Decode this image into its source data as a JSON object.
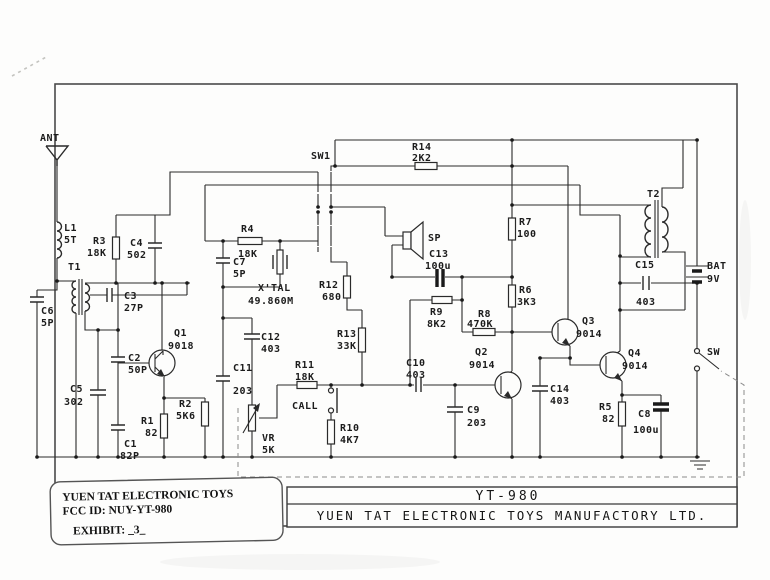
{
  "document": {
    "fcc_label": {
      "company_line": "YUEN TAT ELECTRONIC TOYS",
      "fcc_id_line": "FCC ID: NUY-YT-980",
      "exhibit_line": "EXHIBIT: _3_"
    },
    "title_block": {
      "model": "YT-980",
      "company": "YUEN TAT ELECTRONIC TOYS MANUFACTORY LTD."
    }
  },
  "colors": {
    "ink": "#2a2a2a",
    "paper": "#fdfdfc"
  },
  "schematic": {
    "components": {
      "ant": {
        "ref": "ANT"
      },
      "l1": {
        "ref": "L1",
        "value": "5T"
      },
      "t1": {
        "ref": "T1"
      },
      "t2": {
        "ref": "T2"
      },
      "r1": {
        "ref": "R1",
        "value": "82"
      },
      "r2": {
        "ref": "R2",
        "value": "5K6"
      },
      "r3": {
        "ref": "R3",
        "value": "18K"
      },
      "r4": {
        "ref": "R4",
        "value": "18K"
      },
      "r5": {
        "ref": "R5",
        "value": "82"
      },
      "r6": {
        "ref": "R6",
        "value": "3K3"
      },
      "r7": {
        "ref": "R7",
        "value": "100"
      },
      "r8": {
        "ref": "R8",
        "value": "470K"
      },
      "r9": {
        "ref": "R9",
        "value": "8K2"
      },
      "r10": {
        "ref": "R10",
        "value": "4K7"
      },
      "r11": {
        "ref": "R11",
        "value": "18K"
      },
      "r12": {
        "ref": "R12",
        "value": "680"
      },
      "r13": {
        "ref": "R13",
        "value": "33K"
      },
      "r14": {
        "ref": "R14",
        "value": "2K2"
      },
      "c1": {
        "ref": "C1",
        "value": "82P"
      },
      "c2": {
        "ref": "C2",
        "value": "50P"
      },
      "c3": {
        "ref": "C3",
        "value": "27P"
      },
      "c4": {
        "ref": "C4",
        "value": "502"
      },
      "c5": {
        "ref": "C5",
        "value": "302"
      },
      "c6": {
        "ref": "C6",
        "value": "5P"
      },
      "c7": {
        "ref": "C7",
        "value": "5P"
      },
      "c8": {
        "ref": "C8",
        "value": "100u"
      },
      "c9": {
        "ref": "C9",
        "value": "203"
      },
      "c10": {
        "ref": "C10",
        "value": "403"
      },
      "c11": {
        "ref": "C11",
        "value": "203"
      },
      "c12": {
        "ref": "C12",
        "value": "403"
      },
      "c13": {
        "ref": "C13",
        "value": "100u"
      },
      "c14": {
        "ref": "C14",
        "value": "403"
      },
      "c15": {
        "ref": "C15",
        "value": "403"
      },
      "q1": {
        "ref": "Q1",
        "value": "9018"
      },
      "q2": {
        "ref": "Q2",
        "value": "9014"
      },
      "q3": {
        "ref": "Q3",
        "value": "9014"
      },
      "q4": {
        "ref": "Q4",
        "value": "9014"
      },
      "xtal": {
        "ref": "X'TAL",
        "value": "49.860M"
      },
      "vr": {
        "ref": "VR",
        "value": "5K"
      },
      "sw1": {
        "ref": "SW1"
      },
      "sw": {
        "ref": "SW"
      },
      "call": {
        "ref": "CALL"
      },
      "sp": {
        "ref": "SP"
      },
      "bat": {
        "ref": "BAT",
        "value": "9V"
      }
    }
  }
}
